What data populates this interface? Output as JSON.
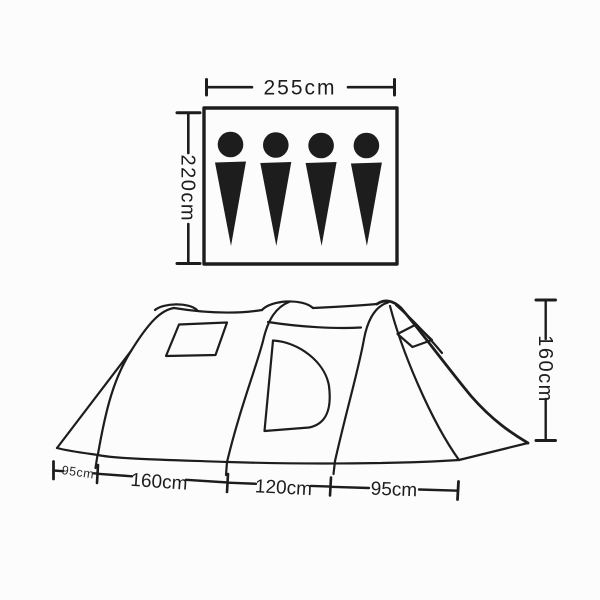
{
  "floorplan": {
    "width_label": "255cm",
    "depth_label": "220cm",
    "capacity_persons": 4,
    "person_icon": "person-silhouette"
  },
  "side_view": {
    "height_label": "160cm",
    "base_labels": [
      "95cm",
      "160cm",
      "120cm",
      "95cm"
    ]
  },
  "colors": {
    "ink": "#1d1d1d",
    "background": "#fcfcfc"
  }
}
